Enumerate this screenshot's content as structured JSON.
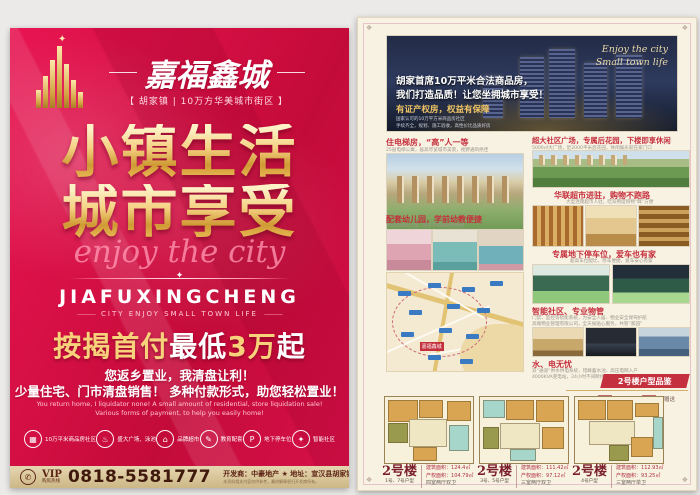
{
  "left_panel": {
    "brand": {
      "name": "嘉福鑫城",
      "subtitle": "【 胡家镇 | 10万方华美城市街区 】"
    },
    "divider_sparkle": "✦",
    "headline1": "小镇生活",
    "headline2": "城市享受",
    "script": "enjoy the city",
    "pinyin": "JIAFUXINGCHENG",
    "tagline": "CITY ENJOY SMALL TOWN LIFE",
    "offer": {
      "prefix": "按揭首付",
      "mid": "最低",
      "amount": "3万",
      "suffix": "起"
    },
    "promo_lines": [
      "您返乡置业，我清盘让利！",
      "少量住宅、门市清盘销售！ 多种付款形式，助您轻松置业！"
    ],
    "promo_en": [
      "You return home, I liquidator none! A small amount of residential, store liquidation sale!",
      "Various forms of payment, to help you easily home!"
    ],
    "features": [
      {
        "icon": "community-building-icon",
        "glyph": "▦",
        "label": "10万平米商品房社区"
      },
      {
        "icon": "plaza-fountain-icon",
        "glyph": "♨",
        "label": "盛大广场、泳池"
      },
      {
        "icon": "supermarket-icon",
        "glyph": "⌂",
        "label": "品牌超市"
      },
      {
        "icon": "education-icon",
        "glyph": "✎",
        "label": "教育配套"
      },
      {
        "icon": "parking-icon",
        "glyph": "P",
        "label": "地下停车位"
      },
      {
        "icon": "smart-community-icon",
        "glyph": "✦",
        "label": "智能社区"
      }
    ],
    "footer": {
      "phone_icon": "✆",
      "vip": "VIP",
      "vip_sub": "购房热线",
      "phone": "0818-5581777",
      "developer": "开发商：中豪地产 ★",
      "address": "地址：宣汉县胡家镇南北大道",
      "note": "本资料相关内容仅供参考，最终解释权归开发商所有。"
    },
    "colors": {
      "base_red": "#d50f44",
      "gold": "#f5d183",
      "footer_tan": "#d8c59a"
    }
  },
  "right_panel": {
    "corner_glyph": "❖",
    "hero": {
      "line1": "胡家首席10万平米合法商品房，",
      "line2": "我们打造品质！让您坐拥城市享受！",
      "highlight": "有证产权房，权益有保障",
      "note1": "国家认可的10万平方米商品房社区",
      "note2": "手续齐全，规划、施工验收，高性价比品质好房",
      "script1": "Enjoy the city",
      "script2": "Small town life"
    },
    "sections": [
      {
        "title": "住电梯房，“高”人一等",
        "subtitle": "25层电梯公寓，居高尽览城市美景，视野通风绝佳"
      },
      {
        "title": "超大社区广场，专属后花园，下楼即享休闲",
        "subtitle": "5000㎡大广场，近2000平米后花园，休闲娱乐就在家门口"
      },
      {
        "title": "配套幼儿园，学前幼教便捷",
        "subtitle": "项目自带幼儿园，孩子学前教育更便捷"
      },
      {
        "title": "华联超市进驻，购物不跑路",
        "subtitle": "大型连锁超市入驻，吃穿用度购物“鲜”方便"
      },
      {
        "title": "专属地下停车位，爱车也有家",
        "subtitle": "超高车位配比，停车便捷，爱车安心有家"
      },
      {
        "title": "智能社区、专业物管",
        "lines": [
          "门禁、监控等智能系统，为安全人居、物业安全保驾护航",
          "高端物业管理有限公司，全天候贴心服务，共管“家园”"
        ]
      },
      {
        "title": "水、电无忧",
        "lines": [
          "双“通道”供水供电系统，错峰蓄水池、高压电网入户",
          "4000KVA变电站，24小时不间断供水供电，生活无忧之选"
        ]
      }
    ],
    "map_label": "嘉福鑫城",
    "ribbon": "2号楼户型品鉴",
    "legend": [
      {
        "label": "全赠送",
        "color": "#f5c98a"
      },
      {
        "label": "半赠送",
        "color": "#cde8e2"
      }
    ],
    "floorplans": [
      {
        "building": "2号楼",
        "unit": "1号、7号户型",
        "area1": "建筑面积：124.4㎡",
        "area2": "产权面积：104.79㎡",
        "layout": "四室两厅双卫"
      },
      {
        "building": "2号楼",
        "unit": "3号、5号户型",
        "area1": "建筑面积：111.42㎡",
        "area2": "产权面积：97.12㎡",
        "layout": "三室两厅双卫"
      },
      {
        "building": "2号楼",
        "unit": "4号户型",
        "area1": "建筑面积：112.93㎡",
        "area2": "产权面积：93.25㎡",
        "layout": "三室两厅单卫"
      }
    ]
  }
}
